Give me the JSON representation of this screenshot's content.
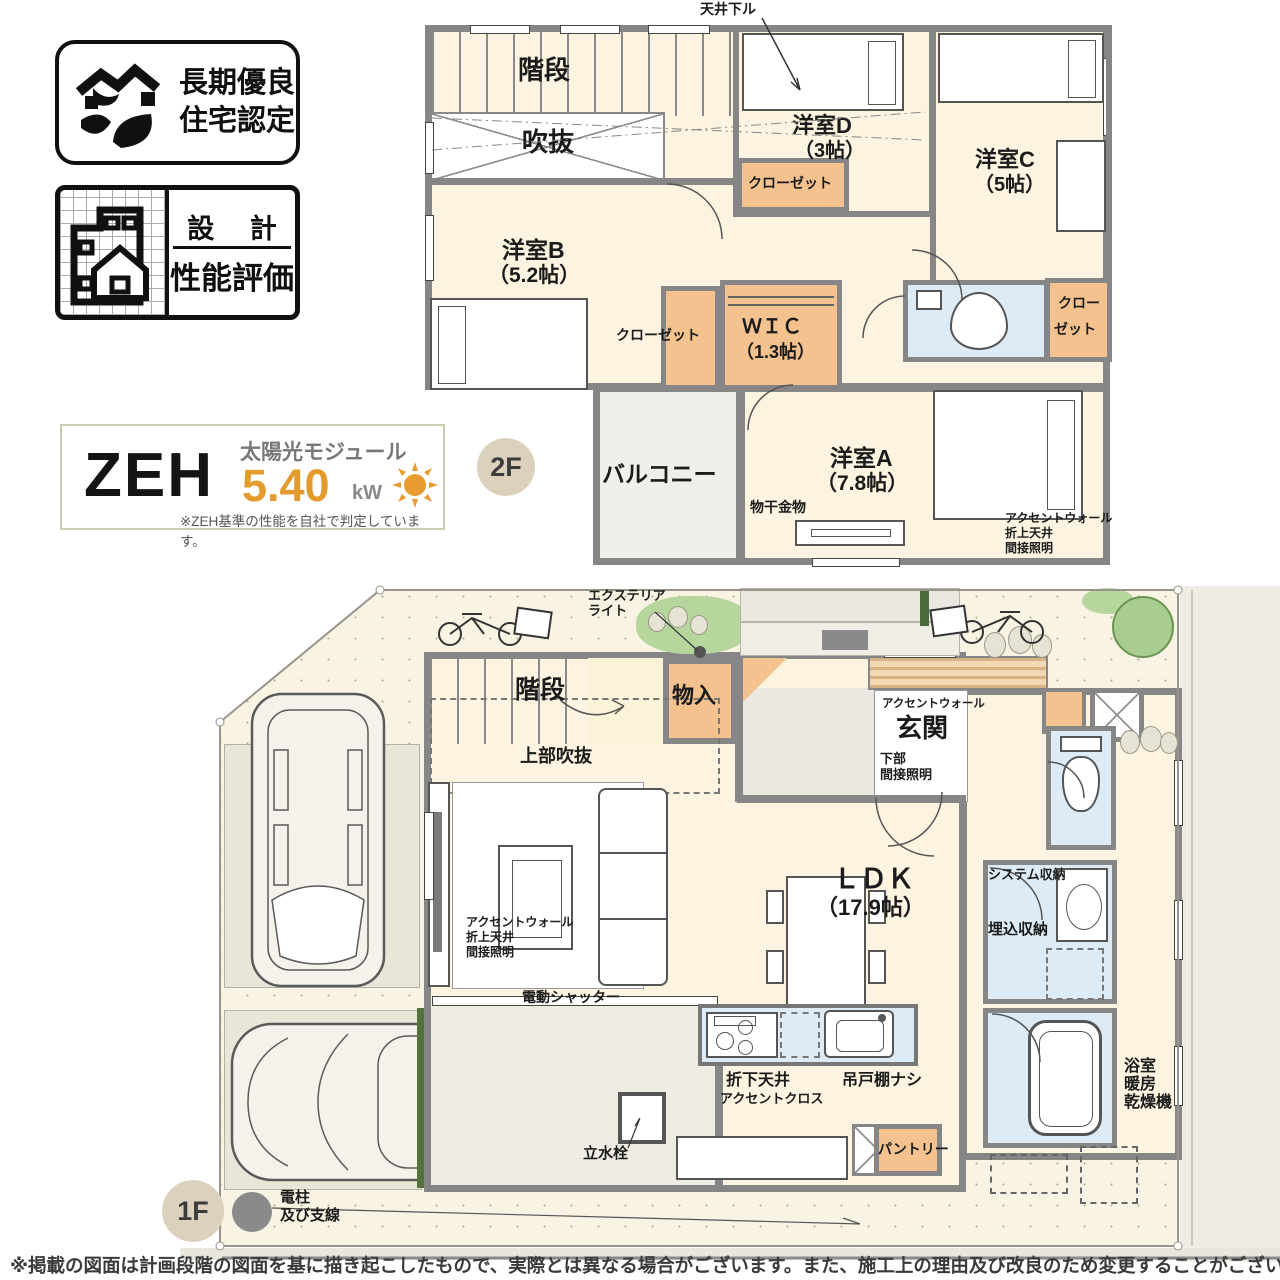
{
  "badges": {
    "long_term": {
      "line1": "長期優良",
      "line2": "住宅認定"
    },
    "design_eval": {
      "top": "設 計",
      "bottom": "性能評価"
    }
  },
  "zeh": {
    "name": "ZEH",
    "module": "太陽光モジュール",
    "capacity": "5.40",
    "unit": "kW",
    "note": "※ZEH基準の性能を自社で判定しています。"
  },
  "f2": {
    "badge": "2F",
    "ceiling_down": "天井下ル",
    "stairs": "階段",
    "void": "吹抜",
    "room_b": "洋室B",
    "room_b_size": "（5.2帖）",
    "closet_b": "クローゼット",
    "wic": "ＷＩＣ",
    "wic_size": "（1.3帖）",
    "room_d": "洋室D",
    "room_d_size": "（3帖）",
    "closet_d": "クローゼット",
    "room_c": "洋室C",
    "room_c_size": "（5帖）",
    "closet_c_1": "クロー",
    "closet_c_2": "ゼット",
    "balcony": "バルコニー",
    "room_a": "洋室A",
    "room_a_size": "（7.8帖）",
    "laundry": "物干金物",
    "accent_1": "アクセントウォール",
    "accent_2": "折上天井",
    "accent_3": "間接照明"
  },
  "f1": {
    "badge": "1F",
    "ext_light_1": "エクステリア",
    "ext_light_2": "ライト",
    "stairs": "階段",
    "upper_void": "上部吹抜",
    "storage": "物入",
    "entr_accent": "アクセントウォール",
    "entrance": "玄関",
    "entr_low_1": "下部",
    "entr_low_2": "間接照明",
    "ldk": "ＬＤＫ",
    "ldk_size": "（17.9帖）",
    "accent_1": "アクセントウォール",
    "accent_2": "折上天井",
    "accent_3": "間接照明",
    "shutter": "電動シャッター",
    "lowered_1": "折下天井",
    "lowered_2": "アクセントクロス",
    "no_cabinet": "吊戸棚ナシ",
    "tap": "立水栓",
    "pantry": "パントリー",
    "sys_storage": "システム収納",
    "built_storage": "埋込収納",
    "bath_dry_1": "浴室",
    "bath_dry_2": "暖房",
    "bath_dry_3": "乾燥機",
    "pole_1": "電柱",
    "pole_2": "及び支線"
  },
  "footer": {
    "disclaimer": "※掲載の図面は計画段階の図面を基に描き起こしたもので、実際とは異なる場合がございます。また、施工上の理由及び改良のため変更することがございます。"
  },
  "colors": {
    "wall": "#868686",
    "floor": "#fcf3e0",
    "closet": "#f4c28f",
    "wet_area": "#dcebf6",
    "zeh_accent": "#e39b2d",
    "site": "#f8f3e2"
  }
}
